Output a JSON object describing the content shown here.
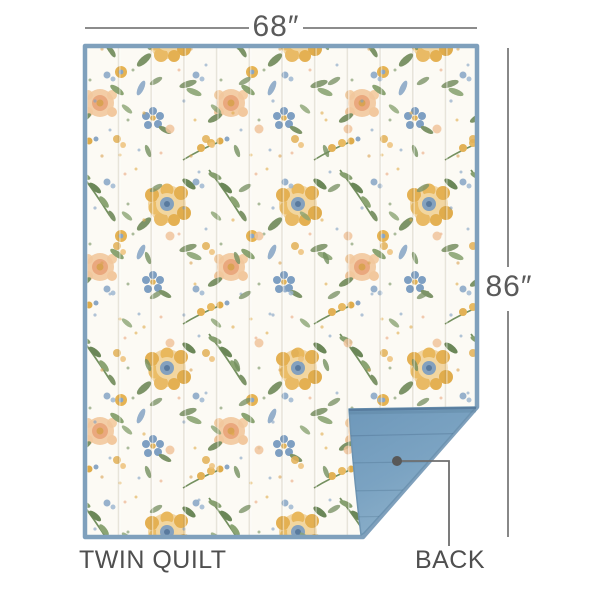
{
  "page": {
    "type": "product-dimension-diagram",
    "product": "quilt"
  },
  "dimensions": {
    "width": "68″",
    "height": "86″"
  },
  "labels": {
    "variant": "TWIN QUILT",
    "back": "BACK"
  },
  "colors": {
    "page_background": "#ffffff",
    "text": "#4f4f4f",
    "dimension_line": "#7b7b7b",
    "leader_line": "#6e6e6e",
    "leader_dot": "#585858",
    "binding_blue": "#7fa0bc",
    "back_blue": "#7ba3c2",
    "back_blue_dark": "#6e98ba",
    "back_blue_light": "#8fb2cb",
    "back_crease": "#54789a",
    "quilt_base": "#fcfaf4",
    "floral_gold": "#e4af4e",
    "floral_peach": "#f0c69f",
    "floral_green": "#7d9468",
    "floral_blue": "#7b9cc0"
  }
}
